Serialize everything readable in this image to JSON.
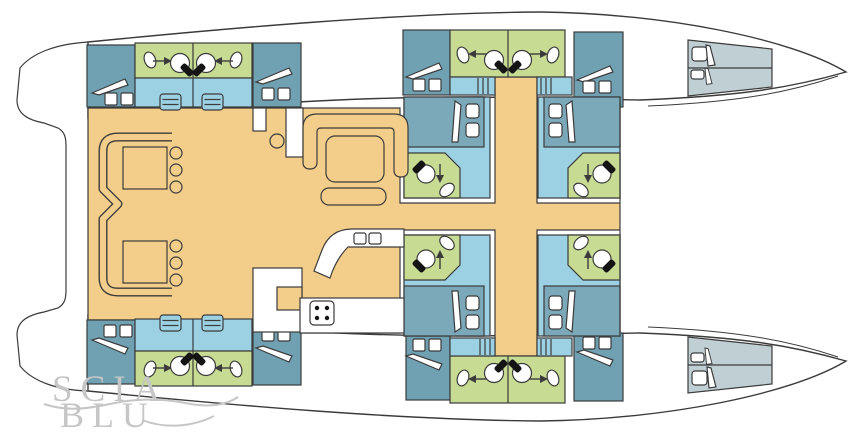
{
  "title": "catamaran-interior-floorplan",
  "watermark": {
    "line1": "SCIA",
    "line2": "BLU"
  },
  "colors": {
    "floor": "#F2CE8A",
    "bathroom": "#C7DB93",
    "cabin_floor": "#9CD0E3",
    "wardrobe": "#6FA1B2",
    "bed": "#7BA9B9",
    "crew_bed": "#BFCFD4",
    "outline": "#3B3B3B",
    "black": "#141414",
    "watermark": "#C6C6C6"
  },
  "icons": {
    "toilet-icon": "circle bowl with black seat wedge",
    "sink-icon": "tilted oval basin",
    "door-arrow-icon": "entry direction arrow",
    "stairs-icon": "slanted companionway blade",
    "steps-icon": "boxed tread steps",
    "companionway-icon": "three tread bars",
    "hatch-icon": "twin white deck hatches",
    "stove-icon": "four burner cooktop",
    "pillow-icon": "bed pillow",
    "door-leaf-icon": "open door leaf",
    "sofa-icon": "u-shaped salon settee",
    "table-icon": "square table",
    "stool-icon": "round seat"
  }
}
